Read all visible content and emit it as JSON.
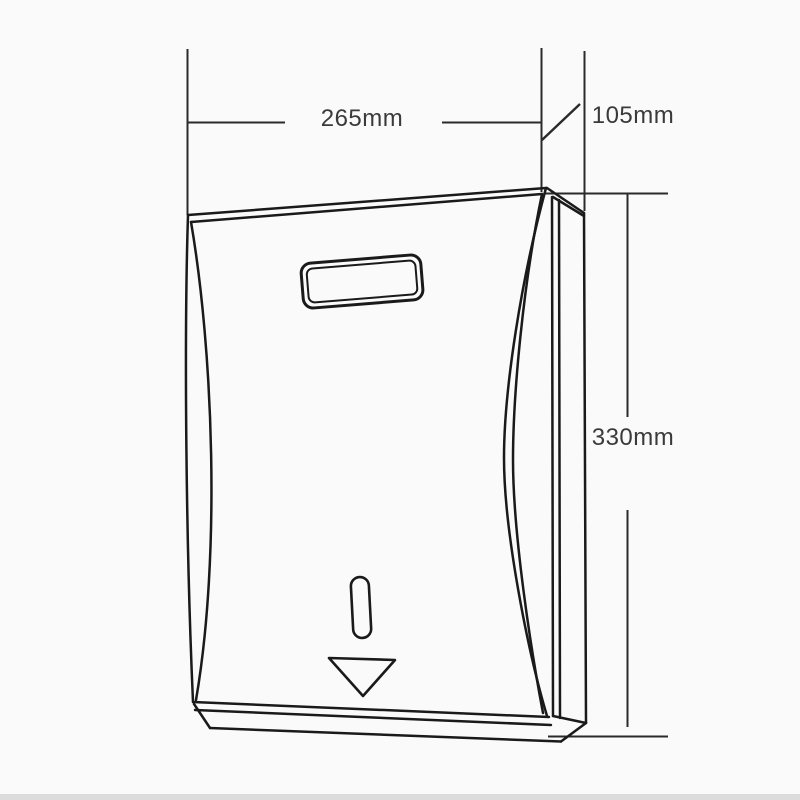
{
  "diagram": {
    "dimensions": {
      "width_label": "265mm",
      "depth_label": "105mm",
      "height_label": "330mm"
    },
    "colors": {
      "background": "#fafafa",
      "outline_line": "#1a1a1a",
      "dimension_line": "#2a2a2a",
      "label_text": "#3a3a3a",
      "bottom_edge_line": "#dcdcdc"
    }
  }
}
